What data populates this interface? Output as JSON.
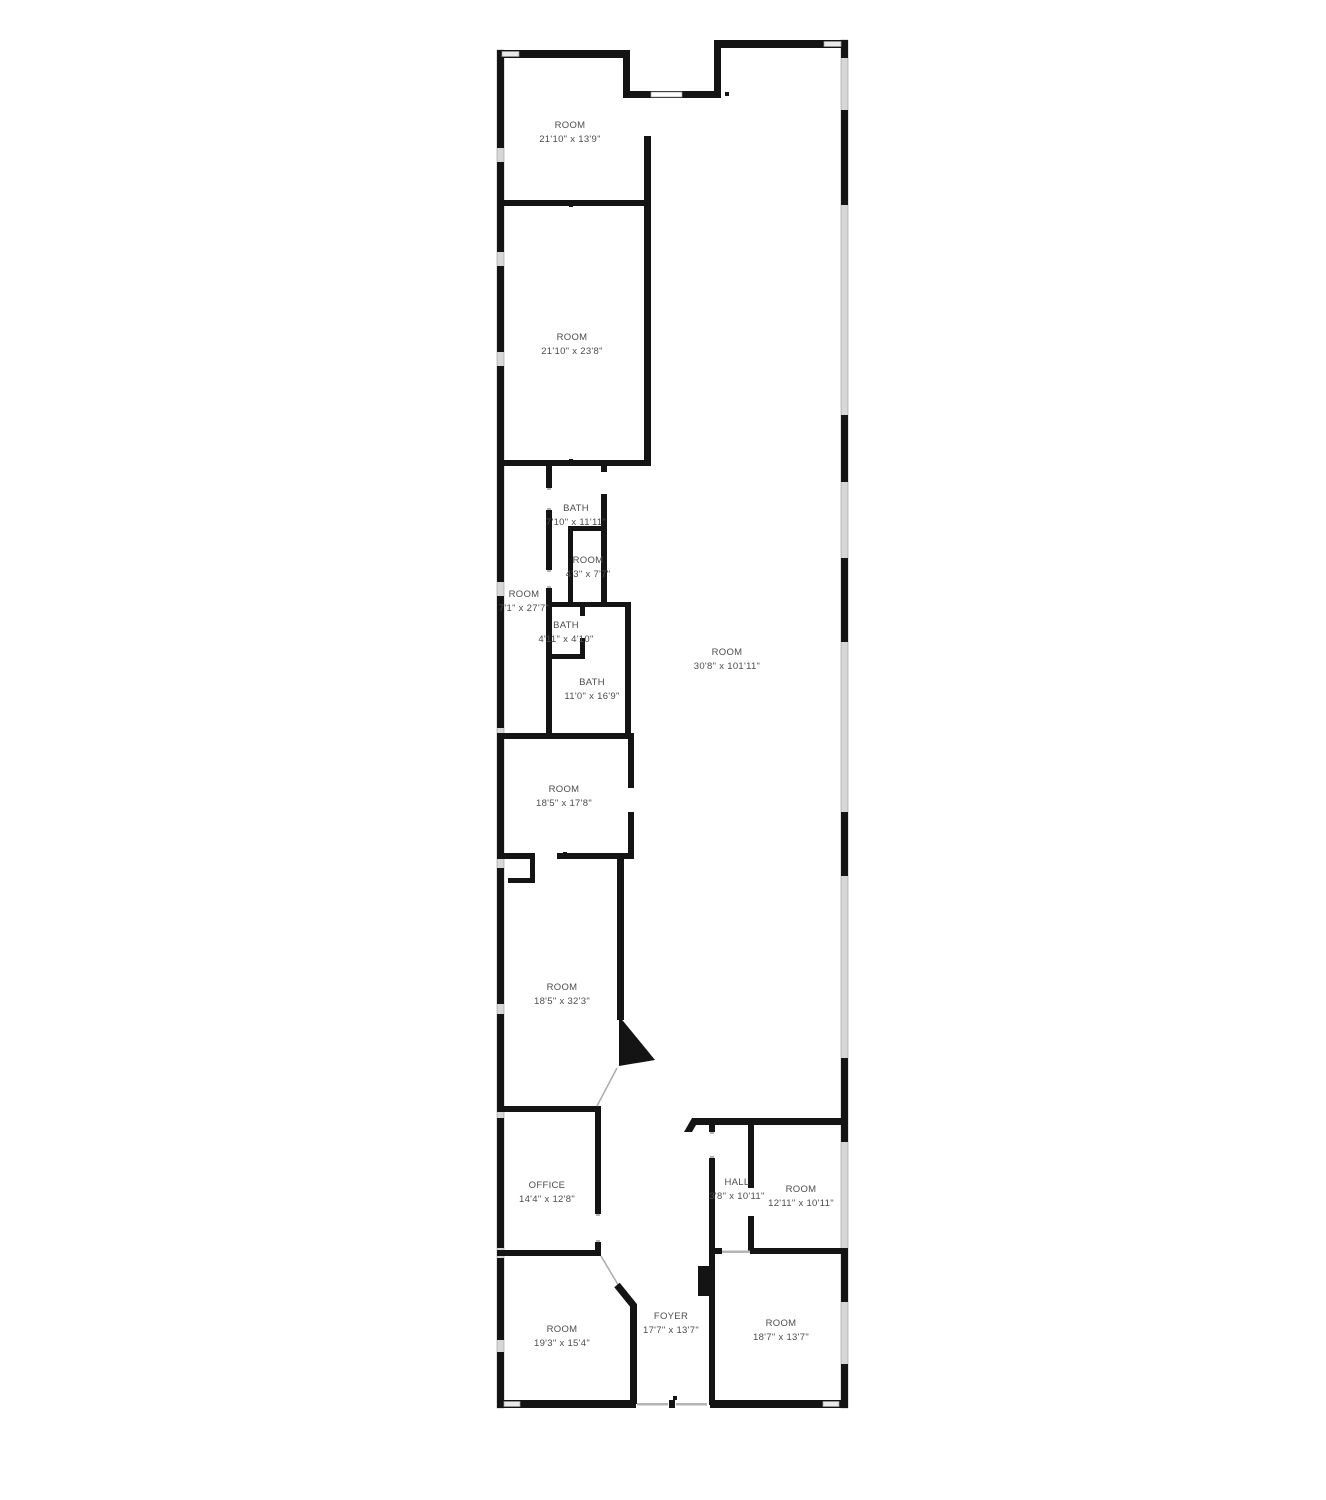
{
  "plan": {
    "type": "floor-plan",
    "wall_color": "#141414",
    "window_color": "#e9e9e9",
    "window_frame_color": "#9a9a9a",
    "exterior_glass_color": "#d7d7d7",
    "label_color": "#4d4d4d",
    "background_color": "#ffffff"
  },
  "rooms": [
    {
      "id": "room-top",
      "label": "ROOM",
      "dims": "21'10\" x 13'9\"",
      "x": 570,
      "y": 133
    },
    {
      "id": "room-2",
      "label": "ROOM",
      "dims": "21'10\" x 23'8\"",
      "x": 572,
      "y": 345
    },
    {
      "id": "room-side-strip",
      "label": "ROOM",
      "dims": "7'1\" x 27'7\"",
      "x": 524,
      "y": 602
    },
    {
      "id": "bath-main",
      "label": "BATH",
      "dims": "7'10\" x 11'11\"",
      "x": 576,
      "y": 516
    },
    {
      "id": "room-small",
      "label": "ROOM",
      "dims": "4'3\" x 7'7\"",
      "x": 588,
      "y": 568
    },
    {
      "id": "bath-small",
      "label": "BATH",
      "dims": "4'11\" x 4'10\"",
      "x": 566,
      "y": 633
    },
    {
      "id": "bath-large",
      "label": "BATH",
      "dims": "11'0\" x 16'9\"",
      "x": 592,
      "y": 690
    },
    {
      "id": "room-main",
      "label": "ROOM",
      "dims": "30'8\" x 101'11\"",
      "x": 727,
      "y": 660
    },
    {
      "id": "room-mid-upper",
      "label": "ROOM",
      "dims": "18'5\" x 17'8\"",
      "x": 564,
      "y": 797
    },
    {
      "id": "room-mid-lower",
      "label": "ROOM",
      "dims": "18'5\" x 32'3\"",
      "x": 562,
      "y": 995
    },
    {
      "id": "office",
      "label": "OFFICE",
      "dims": "14'4\" x 12'8\"",
      "x": 547,
      "y": 1193
    },
    {
      "id": "hall",
      "label": "HALL",
      "dims": "3'8\" x 10'11\"",
      "x": 737,
      "y": 1190
    },
    {
      "id": "room-right-mid",
      "label": "ROOM",
      "dims": "12'11\" x 10'11\"",
      "x": 801,
      "y": 1197
    },
    {
      "id": "room-bottom-left",
      "label": "ROOM",
      "dims": "19'3\" x 15'4\"",
      "x": 562,
      "y": 1337
    },
    {
      "id": "foyer",
      "label": "FOYER",
      "dims": "17'7\" x 13'7\"",
      "x": 671,
      "y": 1324
    },
    {
      "id": "room-bottom-right",
      "label": "ROOM",
      "dims": "18'7\" x 13'7\"",
      "x": 781,
      "y": 1331
    }
  ]
}
